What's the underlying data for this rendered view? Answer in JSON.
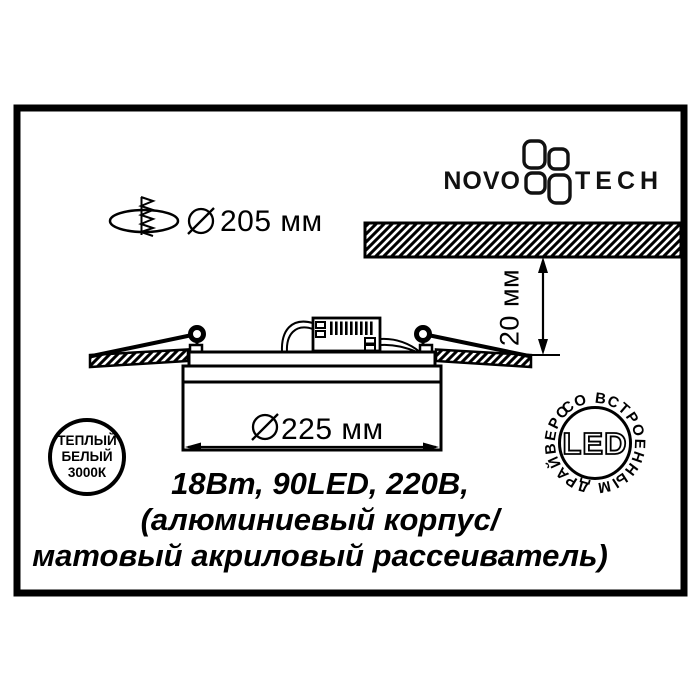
{
  "colors": {
    "ink": "#000000",
    "paper": "#ffffff"
  },
  "brand": {
    "left": "NOVO",
    "right": "TECH"
  },
  "dims": {
    "cutout": "205 мм",
    "depth": "20 мм",
    "body": "225 мм"
  },
  "specs": {
    "line1": "18Вт, 90LED, 220В,",
    "line2": "(алюминиевый корпус/",
    "line3": "матовый акриловый рассеиватель)"
  },
  "badge": {
    "line1": "ТЕПЛЫЙ",
    "line2": "БЕЛЫЙ",
    "line3": "3000К"
  },
  "stamp": {
    "center": "LED",
    "ring": "СО ВСТРОЕННЫМ ДРАЙВЕРОМ"
  }
}
